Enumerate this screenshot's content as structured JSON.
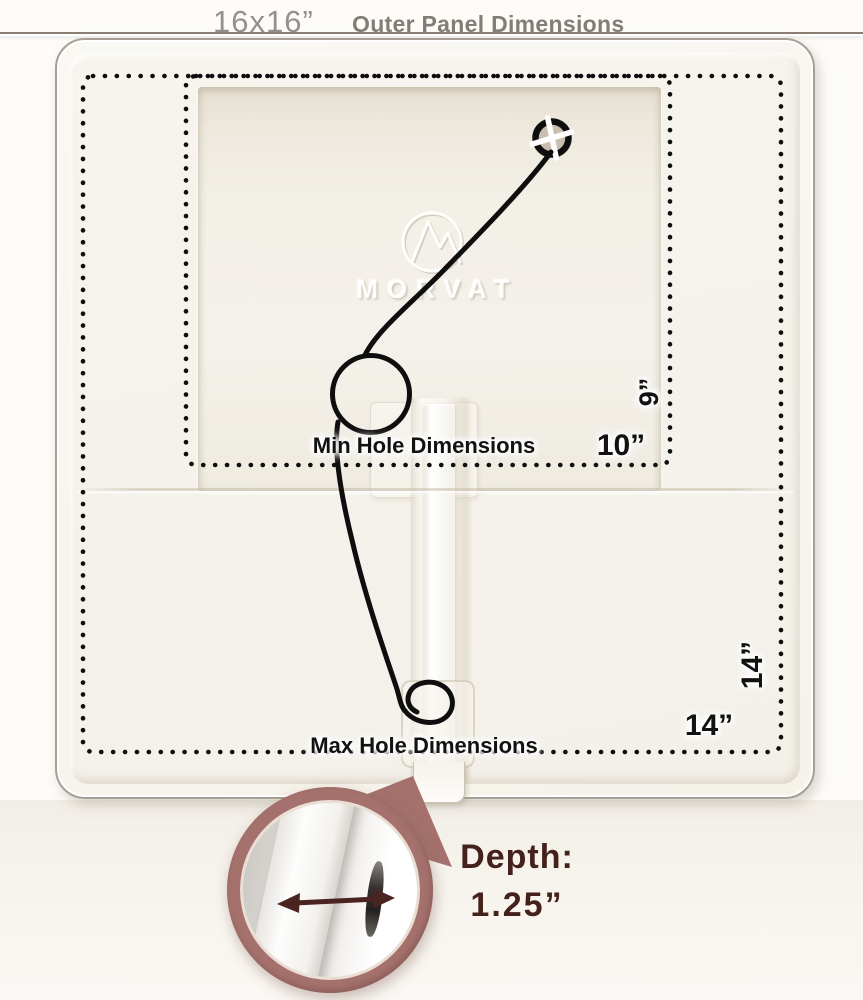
{
  "header": {
    "size_label": "16x16”",
    "title": "Outer Panel Dimensions"
  },
  "panel": {
    "brand_watermark": "MORVAT",
    "min_hole": {
      "label": "Min Hole Dimensions",
      "width_in": "10”",
      "height_in": "9”"
    },
    "max_hole": {
      "label": "Max Hole Dimensions",
      "width_in": "14”",
      "height_in": "14”"
    }
  },
  "depth_callout": {
    "label": "Depth:",
    "value": "1.25”"
  },
  "colors": {
    "accent": "#a4716c",
    "accent_dark": "#8f5f5b",
    "depth_text": "#44211b",
    "arrow": "#4a2420",
    "line": "#0e0e0e",
    "label_text": "#121212",
    "title_text": "#95908a",
    "title_bold": "#837d76",
    "rule": "#8b7e75",
    "panel_border": "#a79f94"
  }
}
